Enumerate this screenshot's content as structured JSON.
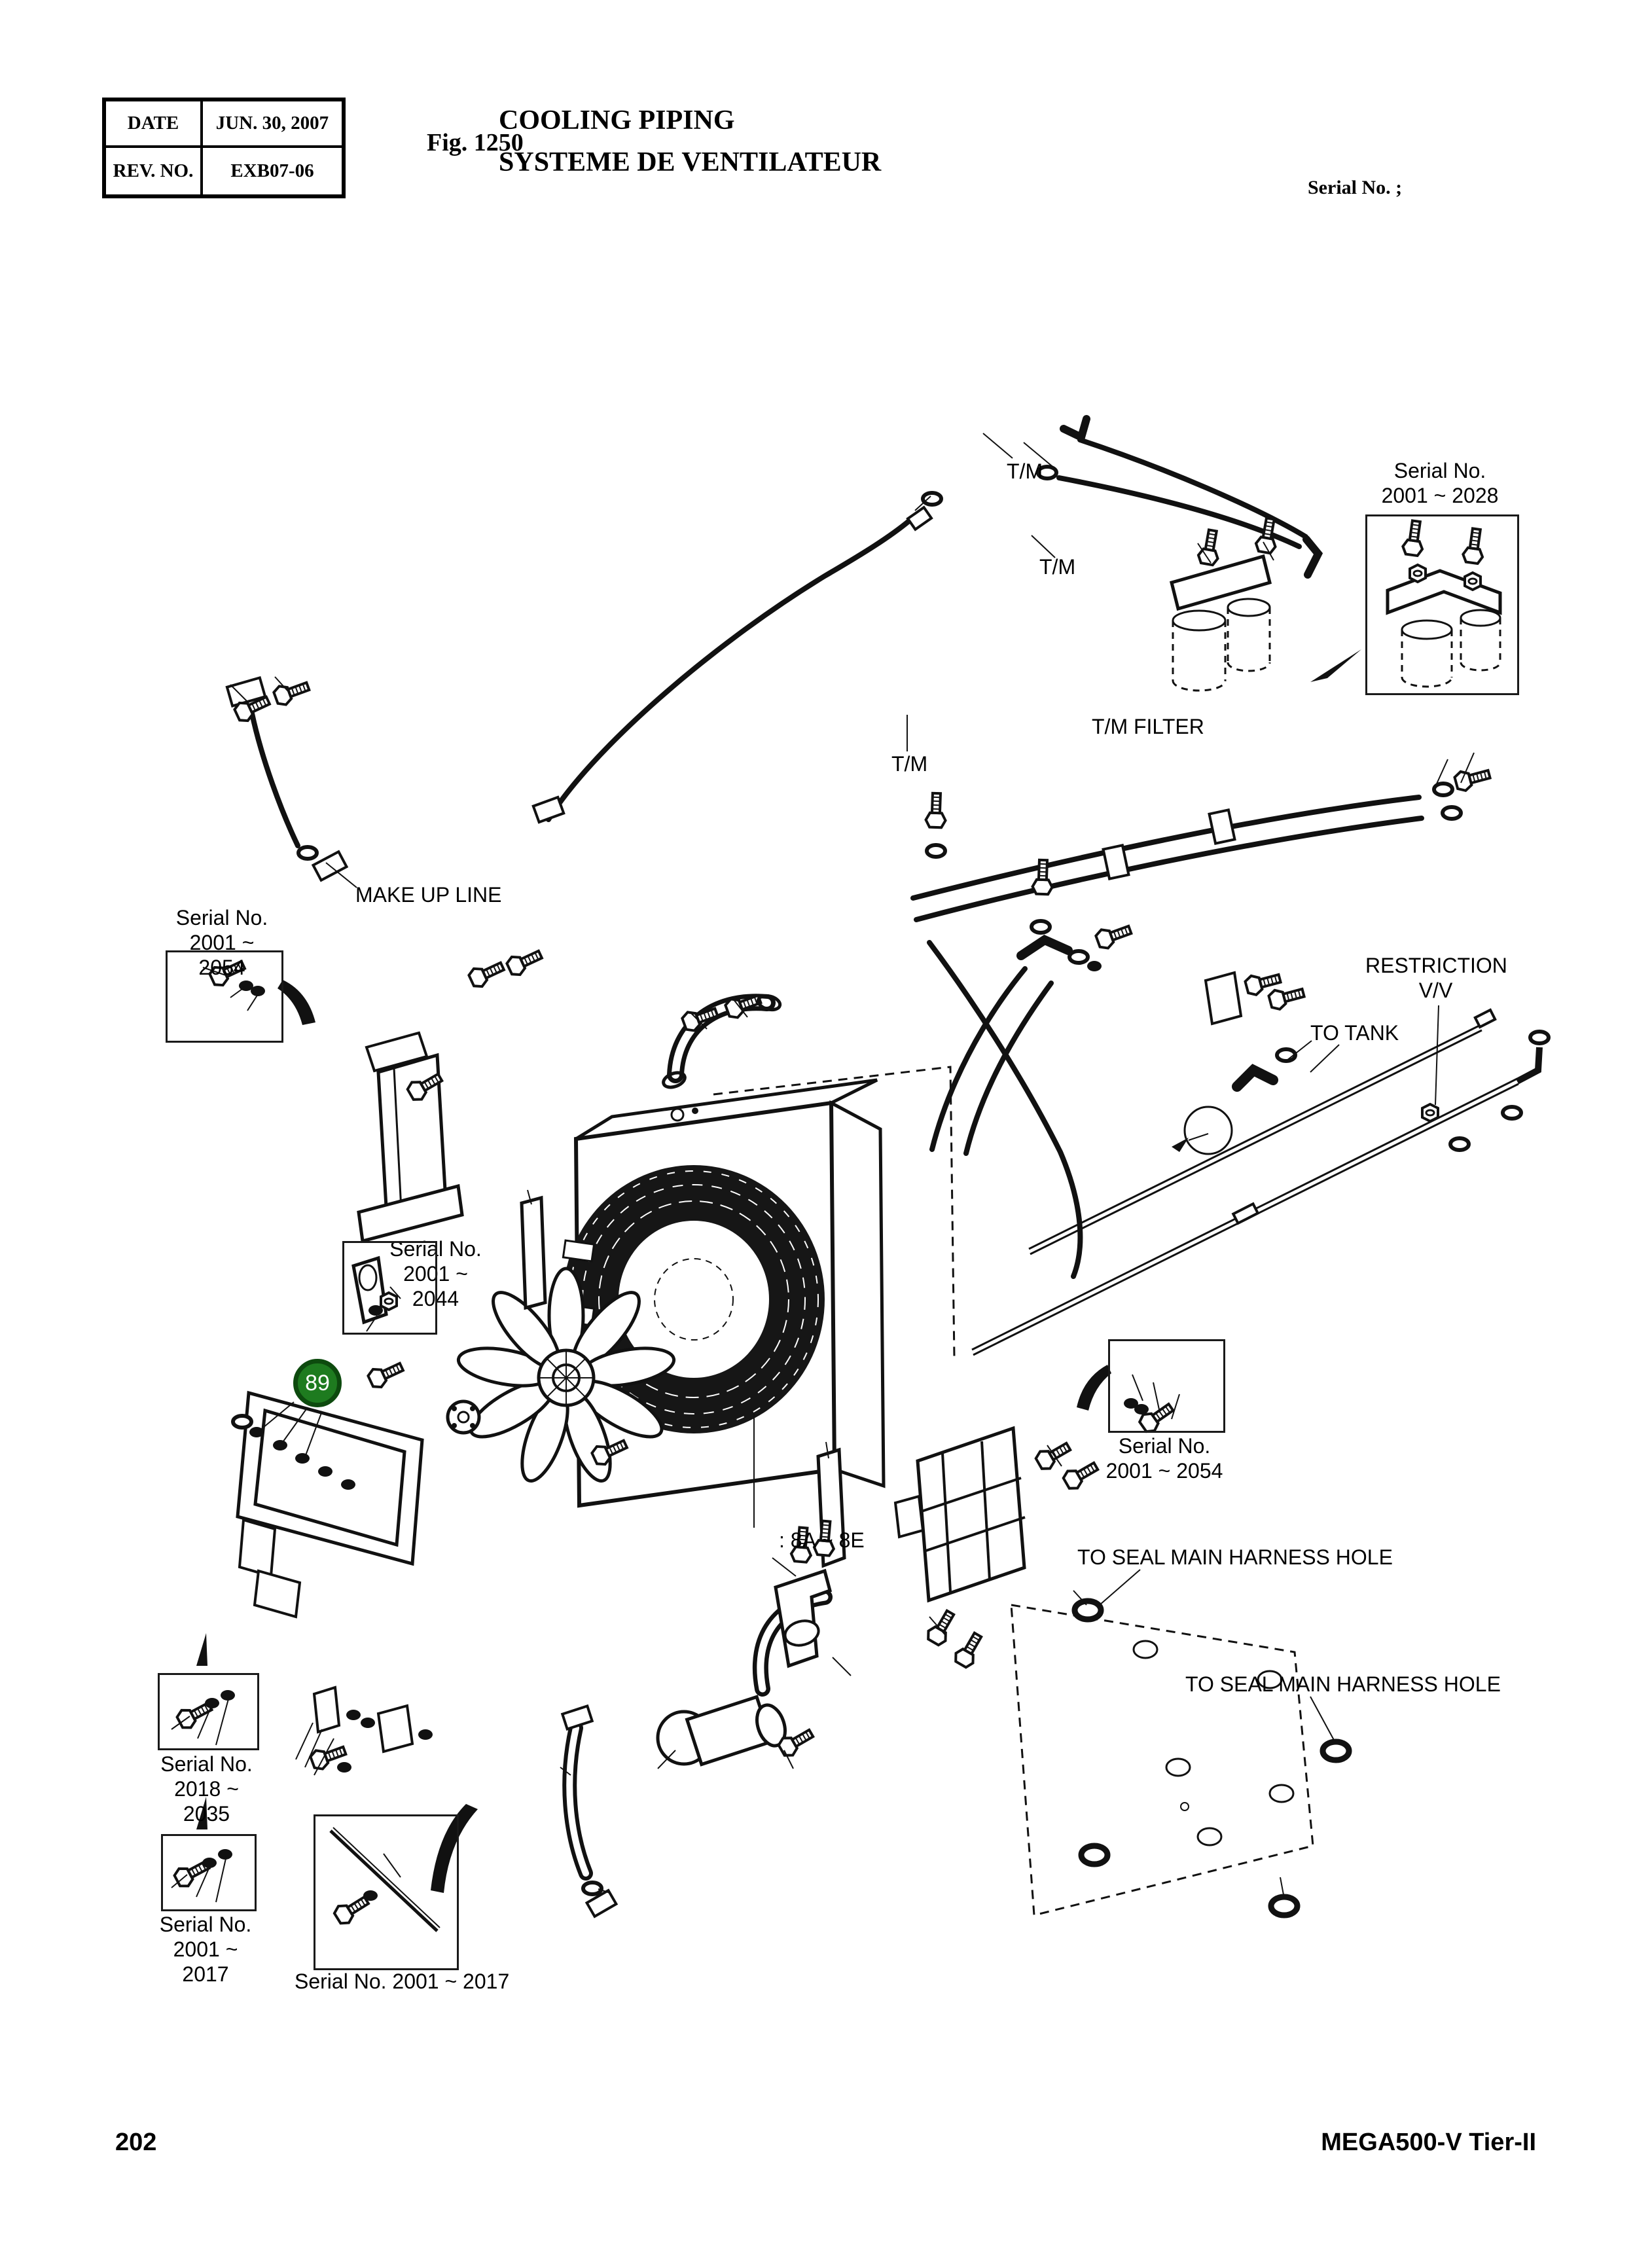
{
  "header": {
    "date_label": "DATE",
    "date_value": "JUN. 30, 2007",
    "rev_label": "REV. NO.",
    "rev_value": "EXB07-06",
    "figure_label": "Fig. 1250",
    "title_line1": "COOLING PIPING",
    "title_line2": "SYSTEME DE VENTILATEUR",
    "serial_note": "Serial No. ;"
  },
  "diagram_labels": {
    "tm_top": "T/M",
    "tm_mid": "T/M",
    "tm_lower": "T/M",
    "tm_filter": "T/M FILTER",
    "make_up_line": "MAKE UP LINE",
    "restriction_line1": "RESTRICTION",
    "restriction_line2": "V/V",
    "to_tank": "TO TANK",
    "range_note": ": 8A ~ 8E",
    "seal_harness_upper": "TO SEAL MAIN HARNESS HOLE",
    "seal_harness_lower": "TO SEAL MAIN HARNESS HOLE"
  },
  "serial_callouts": {
    "top_right": {
      "line1": "Serial No.",
      "line2": "2001 ~ 2028"
    },
    "left": {
      "line1": "Serial No.",
      "line2": "2001 ~ 2054"
    },
    "center": {
      "line1": "Serial No.",
      "line2": "2001 ~ 2044"
    },
    "right": {
      "line1": "Serial No.",
      "line2": "2001 ~ 2054"
    },
    "bottom_left_upper": {
      "line1": "Serial No.",
      "line2": "2018 ~ 2035"
    },
    "bottom_left_lower": {
      "line1": "Serial No.",
      "line2": "2001 ~ 2017"
    },
    "bottom_center": {
      "text": "Serial No. 2001 ~ 2017"
    }
  },
  "part_marker": {
    "number": "89",
    "fill_color": "#1e7b1f",
    "ring_color": "#0d4a0e",
    "text_color": "#ffffff"
  },
  "footer": {
    "page_number": "202",
    "model": "MEGA500-V Tier-II"
  }
}
